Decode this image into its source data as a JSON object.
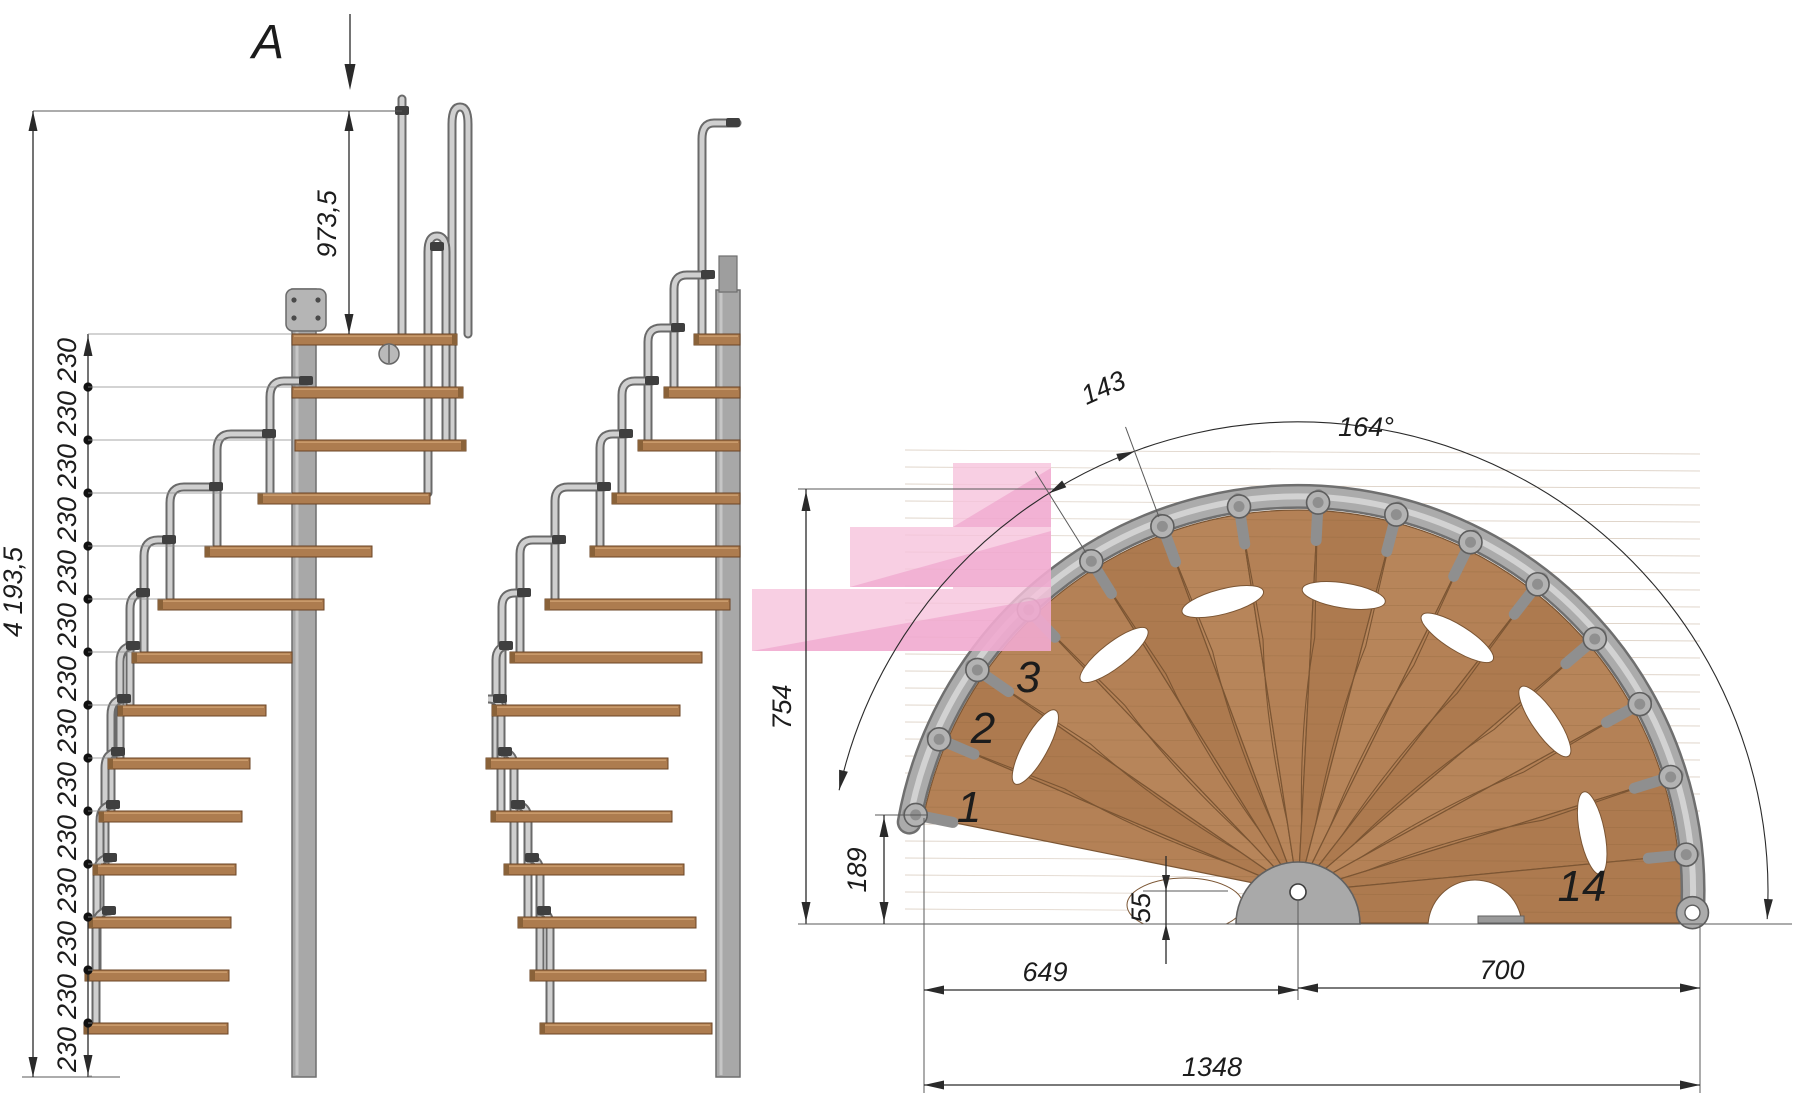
{
  "drawing": {
    "section_label": "A",
    "elevation": {
      "total_height": "4 193,5",
      "top_flight_height": "973,5",
      "step_rise": "230",
      "step_interval_count": 14,
      "tread_count": 14
    },
    "plan": {
      "fan_angle": "164°",
      "tread_pitch_arc": "143",
      "fan_height": "754",
      "entry_corner_offset": "189",
      "pole_axis_offset": "55",
      "span_left_of_pole": "649",
      "span_right_of_pole": "700",
      "total_span": "1348",
      "tread_numbers": {
        "first": "1",
        "second": "2",
        "third": "3",
        "last": "14"
      }
    },
    "colors": {
      "wood": "#b28055",
      "wood_dark_line": "#7b5533",
      "rail_gray": "#ababab",
      "pole_gray": "#a8a8a8",
      "clamp_dark": "#3f3f3f",
      "dimension_line": "#2a2a2a",
      "highlight_pink": "#f6c3dc",
      "highlight_pink_dark": "#ec96c6"
    }
  }
}
